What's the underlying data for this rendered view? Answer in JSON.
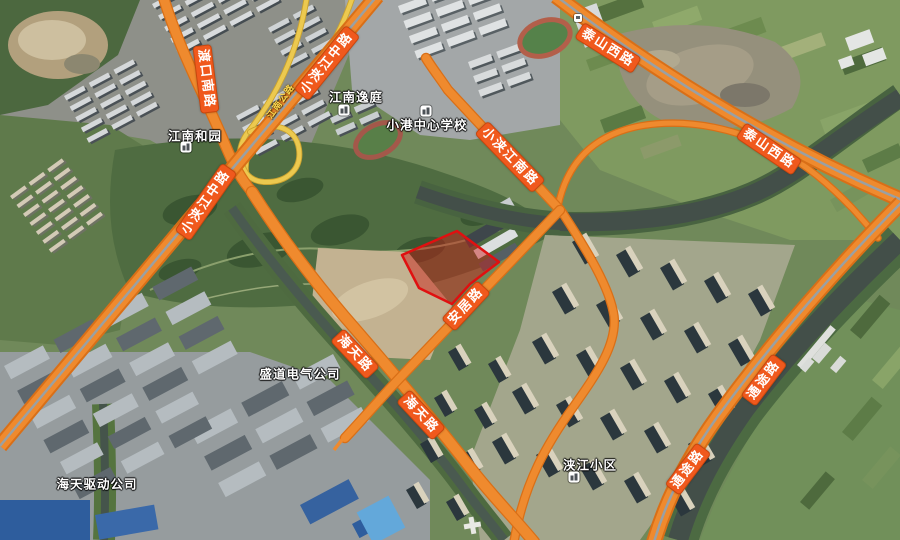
{
  "map": {
    "type": "satellite-map-view",
    "road_labels": [
      {
        "id": "taishan-west-road-1",
        "text": "泰山西路",
        "x": 608,
        "y": 48,
        "rot": 32
      },
      {
        "id": "taishan-west-road-2",
        "text": "泰山西路",
        "x": 769,
        "y": 149,
        "rot": 34
      },
      {
        "id": "tongtu-road-1",
        "text": "通途路",
        "x": 764,
        "y": 380,
        "rot": -53
      },
      {
        "id": "tongtu-road-2",
        "text": "通途路",
        "x": 688,
        "y": 469,
        "rot": -53
      },
      {
        "id": "xiaojiajiang-middle-road-1",
        "text": "小浃江中路",
        "x": 327,
        "y": 63,
        "rot": -51
      },
      {
        "id": "xiaojiajiang-middle-road-2",
        "text": "小浃江中路",
        "x": 206,
        "y": 202,
        "rot": -55
      },
      {
        "id": "xiaojiajiang-south-road",
        "text": "小浃江南路",
        "x": 510,
        "y": 157,
        "rot": 46
      },
      {
        "id": "anju-road",
        "text": "安居路",
        "x": 466,
        "y": 306,
        "rot": -47
      },
      {
        "id": "haitian-road-1",
        "text": "海天路",
        "x": 355,
        "y": 354,
        "rot": 47
      },
      {
        "id": "haitian-road-2",
        "text": "海天路",
        "x": 421,
        "y": 415,
        "rot": 47
      },
      {
        "id": "dukou-south-road",
        "text": "渡口南路",
        "x": 206,
        "y": 79,
        "rot": 83
      }
    ],
    "minor_road_label": {
      "id": "jiangnan-highway",
      "text": "江南公路",
      "x": 280,
      "y": 101,
      "rot": -54
    },
    "poi_labels": [
      {
        "id": "jiangnan-heyuan",
        "text": "江南和园",
        "x": 195,
        "y": 135,
        "icon_x": 186,
        "icon_y": 147,
        "icon_pos": "below"
      },
      {
        "id": "jiangnan-yiting",
        "text": "江南逸庭",
        "x": 356,
        "y": 96,
        "icon_x": 344,
        "icon_y": 110,
        "icon_pos": "below"
      },
      {
        "id": "xiaogang-central-school",
        "text": "小港中心学校",
        "x": 427,
        "y": 124,
        "icon_x": 426,
        "icon_y": 111,
        "icon_pos": "above"
      },
      {
        "id": "shengdao-electric-company",
        "text": "盛道电气公司",
        "x": 300,
        "y": 373
      },
      {
        "id": "haitian-drive-company",
        "text": "海天驱动公司",
        "x": 97,
        "y": 483
      },
      {
        "id": "jiajiang-residential-area",
        "text": "浃江小区",
        "x": 590,
        "y": 464,
        "icon_x": 574,
        "icon_y": 477,
        "icon_pos": "below"
      }
    ],
    "highlighted_parcel": {
      "description": "red highlighted land parcel outline",
      "points": [
        [
          402,
          255
        ],
        [
          457,
          231
        ],
        [
          499,
          262
        ],
        [
          470,
          284
        ],
        [
          452,
          304
        ],
        [
          419,
          288
        ]
      ],
      "fill": "rgba(205,25,20,0.45)",
      "stroke": "#e01010"
    },
    "colors": {
      "road_fill": "#ef8a2e",
      "road_border": "#d96f17",
      "ramp_fill": "#ecc94f",
      "label_bg": "#f0591d",
      "label_text": "#ffffff",
      "water": "#434f49",
      "minor_label_text": "#ffd84e"
    }
  }
}
